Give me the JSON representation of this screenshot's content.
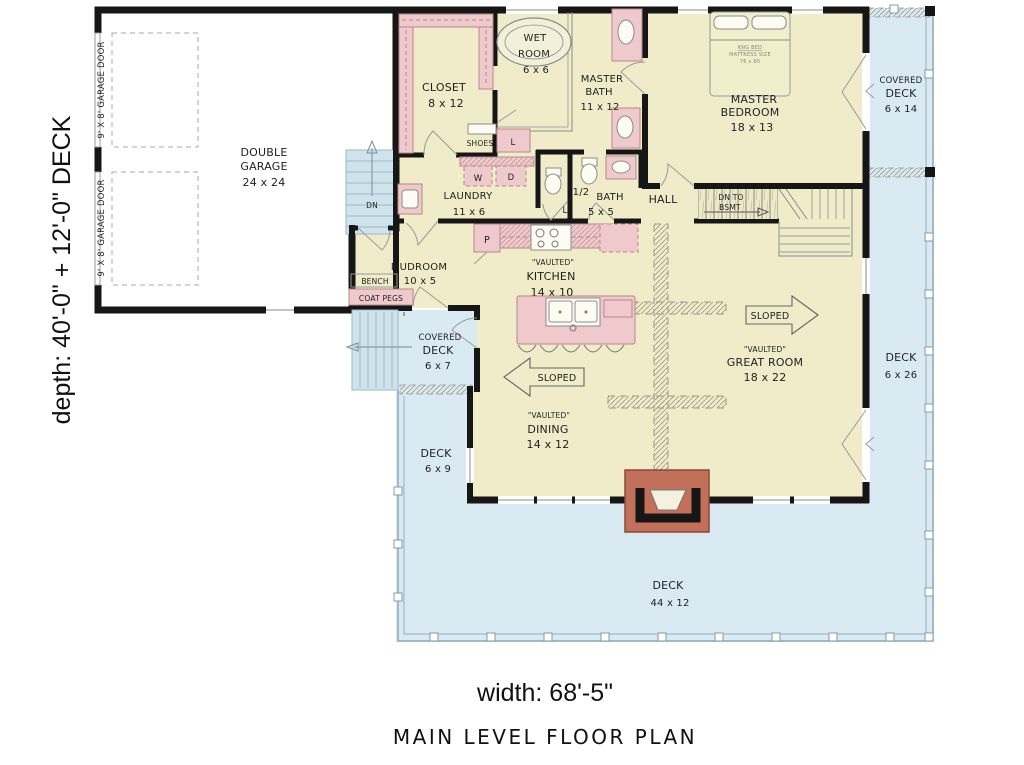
{
  "title": "MAIN LEVEL FLOOR PLAN",
  "dimensions": {
    "width": "width: 68'-5\"",
    "depth": "depth: 40'-0\" + 12'-0\" DECK"
  },
  "rooms": {
    "garage": {
      "line1": "DOUBLE",
      "line2": "GARAGE",
      "size": "24 x 24"
    },
    "closet": {
      "name": "CLOSET",
      "size": "8 x 12"
    },
    "wet_room": {
      "line1": "WET",
      "line2": "ROOM",
      "size": "6 x 6"
    },
    "master_bath": {
      "line1": "MASTER",
      "line2": "BATH",
      "size": "11 x 12"
    },
    "master_bedroom": {
      "line1": "MASTER",
      "line2": "BEDROOM",
      "size": "18 x 13"
    },
    "covered_deck_ne": {
      "line1": "COVERED",
      "line2": "DECK",
      "size": "6 x 14"
    },
    "deck_east": {
      "name": "DECK",
      "size": "6 x 26"
    },
    "laundry": {
      "name": "LAUNDRY",
      "size": "11 x 6"
    },
    "half_bath": {
      "line1": "1/2",
      "line2": "BATH",
      "size": "5 x 5"
    },
    "hall": {
      "name": "HALL"
    },
    "mudroom": {
      "name": "MUDROOM",
      "size": "10 x 5"
    },
    "kitchen": {
      "note": "\"VAULTED\"",
      "name": "KITCHEN",
      "size": "14 x 10"
    },
    "covered_deck_west": {
      "line1": "COVERED",
      "line2": "DECK",
      "size": "6 x 7"
    },
    "deck_west": {
      "name": "DECK",
      "size": "6 x 9"
    },
    "great_room": {
      "note": "\"VAULTED\"",
      "name": "GREAT ROOM",
      "size": "18 x 22"
    },
    "dining": {
      "note": "\"VAULTED\"",
      "name": "DINING",
      "size": "14 x 12"
    },
    "deck_south": {
      "name": "DECK",
      "size": "44 x 12"
    }
  },
  "fixtures": {
    "bench": "BENCH",
    "coat_pegs": "COAT PEGS",
    "shoes": "SHOES",
    "washer": "W",
    "dryer": "D",
    "pantry": "P",
    "linen": "L",
    "bed_line1": "KNG BED",
    "bed_line2": "MATTRESS SIZE",
    "bed_line3": "76 x 80"
  },
  "annotations": {
    "sloped": "SLOPED",
    "dn": "DN",
    "dn_to_bsmt_line1": "DN TO",
    "dn_to_bsmt_line2": "BSMT",
    "garage_door": "9' X 8' GARAGE DOOR"
  },
  "colors": {
    "room_fill": "#f0ecc9",
    "deck_fill": "#d9eaf2",
    "stair_fill": "#cfe3ed",
    "fixture_pink": "#efc9cb",
    "fireplace_red": "#c3705b",
    "wall": "#161616"
  }
}
